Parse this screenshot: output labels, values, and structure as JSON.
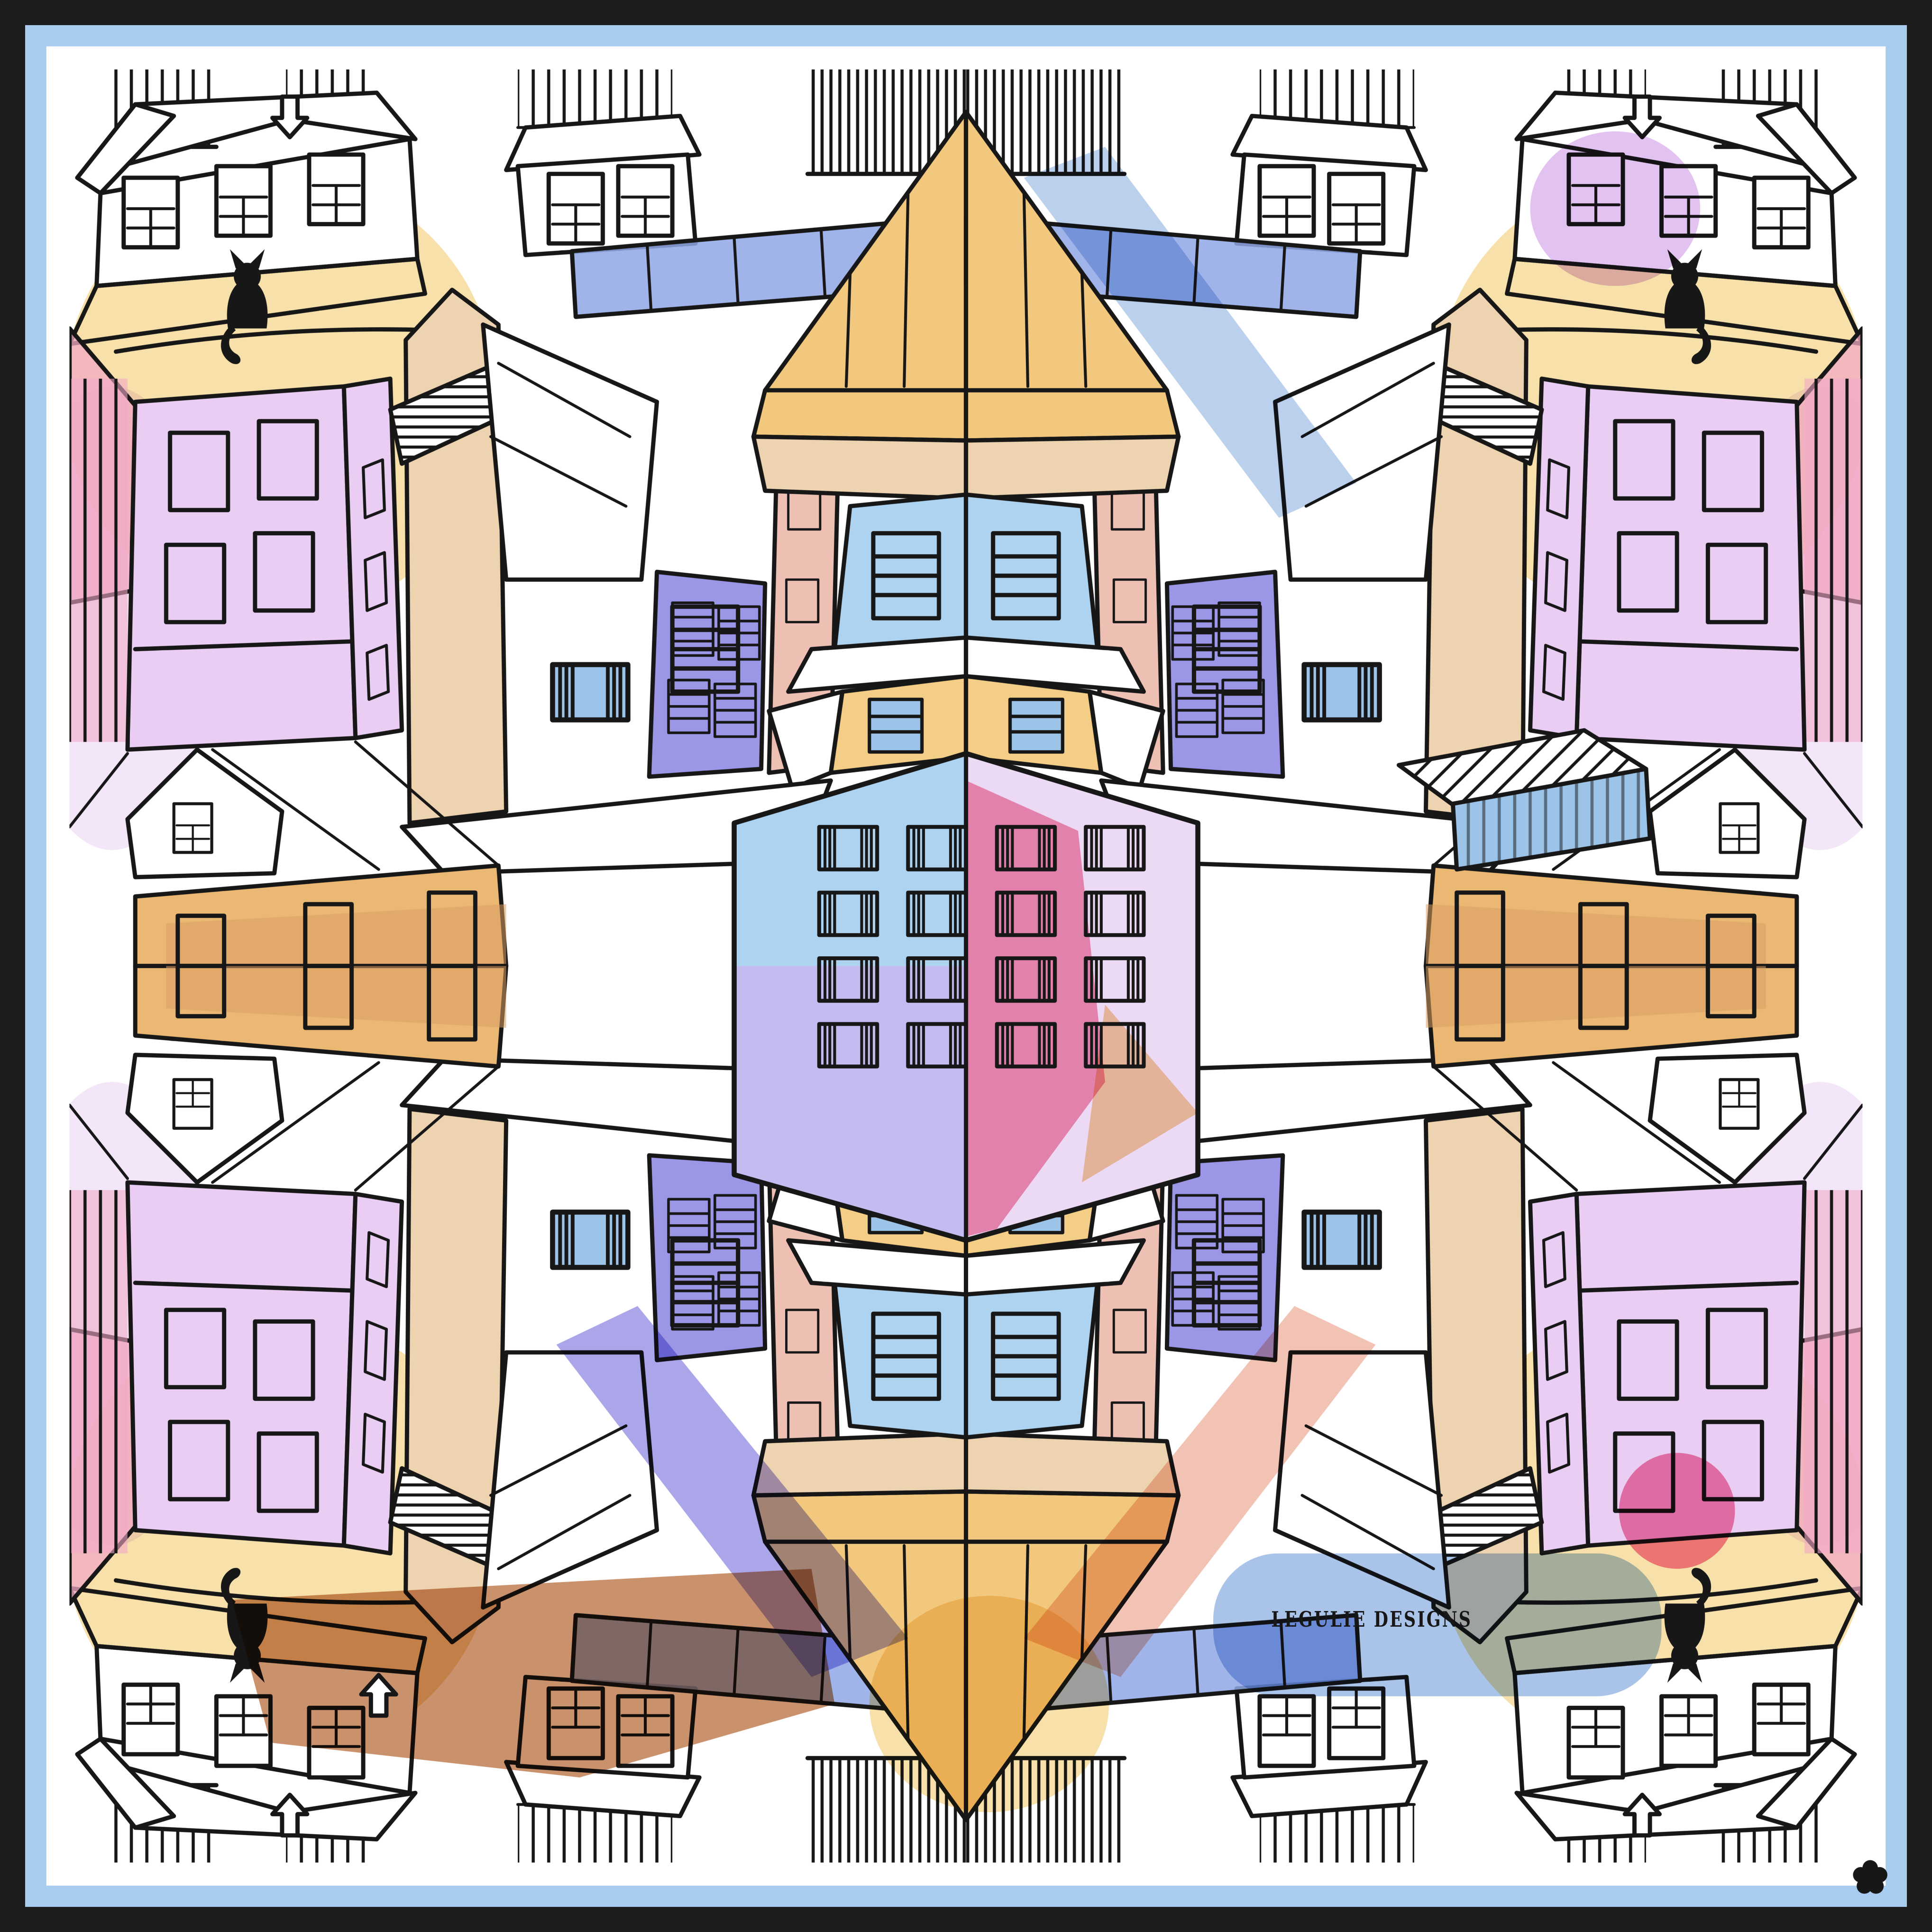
{
  "artwork": {
    "kind": "hand-drawn-house-pattern-illustration",
    "signature": "LEGULIE DESIGNS",
    "motifs": {
      "cats_visible": 4,
      "flower_mark": 1,
      "arrow_chimneys": 4,
      "center_house_shape": "hexagon",
      "symmetry": "mirrored-horizontally-and-vertically"
    },
    "icons": {
      "cat": "black sitting cat silhouette",
      "flower": "black 5-petal flower mark",
      "arrow-chimney": "downward arrow chimney outline"
    }
  },
  "palette": {
    "border_black": "#1c1c1c",
    "border_blue": "#a8cdf1",
    "paper": "#ffffff",
    "ink": "#171717",
    "gold": "#f2c87e",
    "wall_yellow": "#f4cd86",
    "amber": "#eab873",
    "amber_dark": "#d89f63",
    "tan_light": "#eed3b0",
    "terracotta": "#c4845c",
    "lilac": "#e9cdf3",
    "lilac_wash": "#ddb7ee",
    "lilac_light": "#ecd9f4",
    "periwinkle": "#9b96e5",
    "periwinkle_light": "#c4bcf0",
    "sky_blue": "#9cc3e8",
    "sky_blue_light": "#aed3f0",
    "fence_blue": "#8fa7e6",
    "wash_blue": "#a9c4e8",
    "wash_yellow": "#f7e0a9",
    "wash_pink": "#f2a9c6",
    "pink_stripe": "#e0649a",
    "pink_wash": "#f398b4",
    "pink_circle": "#f2779f",
    "salmon": "#f0b8a6",
    "rose": "#eec0b4",
    "peach": "#f6d2a0"
  }
}
